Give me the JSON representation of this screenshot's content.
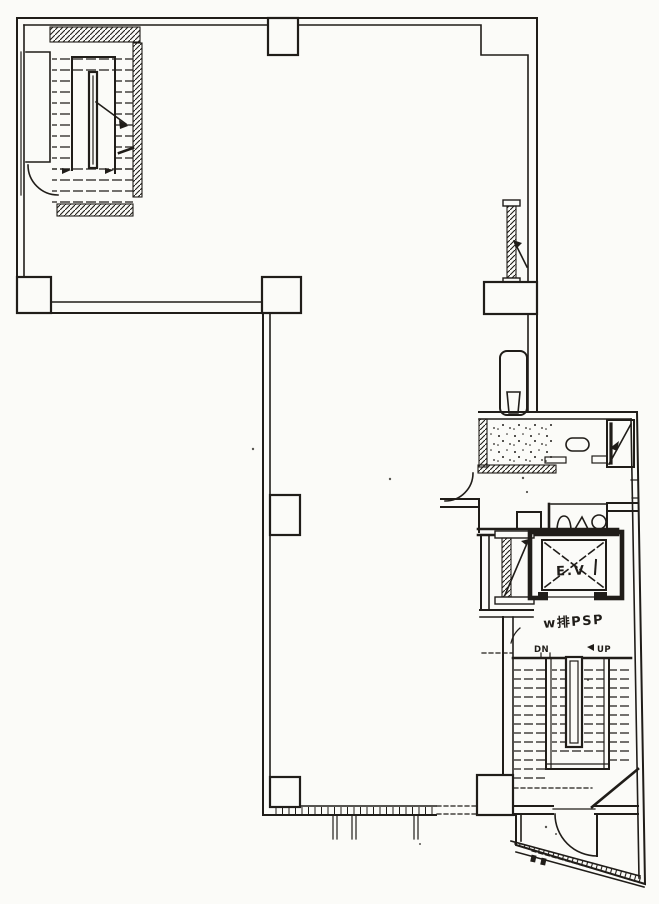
{
  "plan": {
    "colors": {
      "ink": "#201d19",
      "paper": "#fbfbf8"
    },
    "labels": {
      "dn": "DN",
      "up": "UP",
      "elevator": "E.V",
      "note": "w排PSP"
    }
  }
}
